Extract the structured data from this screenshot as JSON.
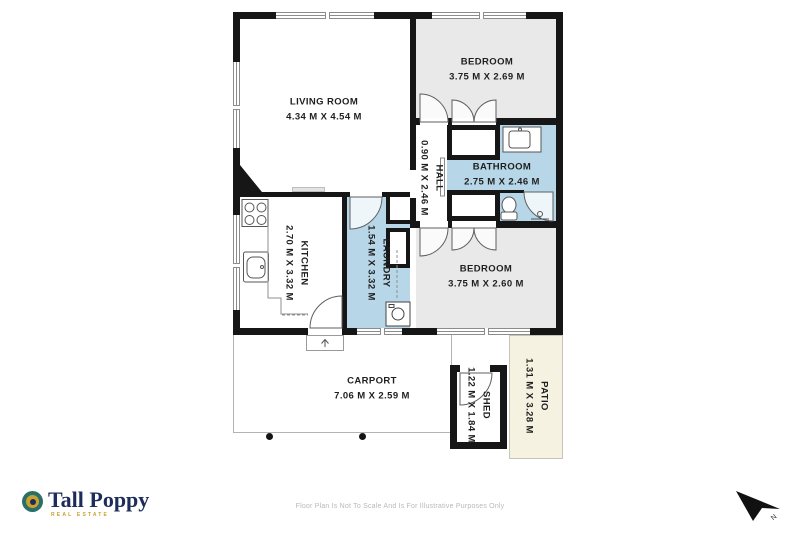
{
  "plan": {
    "rooms": [
      {
        "id": "living-room",
        "name": "LIVING ROOM",
        "dims": "4.34 M X 4.54 M"
      },
      {
        "id": "bedroom-1",
        "name": "BEDROOM",
        "dims": "3.75 M X 2.69 M"
      },
      {
        "id": "bathroom",
        "name": "BATHROOM",
        "dims": "2.75 M X 2.46 M"
      },
      {
        "id": "hall",
        "name": "HALL",
        "dims": "0.90 M X 2.46 M"
      },
      {
        "id": "kitchen",
        "name": "KITCHEN",
        "dims": "2.70 M X 3.32 M"
      },
      {
        "id": "laundry",
        "name": "LAUNDRY",
        "dims": "1.54 M X 3.32 M"
      },
      {
        "id": "bedroom-2",
        "name": "BEDROOM",
        "dims": "3.75 M X 2.60 M"
      },
      {
        "id": "carport",
        "name": "CARPORT",
        "dims": "7.06 M X 2.59 M"
      },
      {
        "id": "shed",
        "name": "SHED",
        "dims": "1.22 M X 1.84 M"
      },
      {
        "id": "patio",
        "name": "PATIO",
        "dims": "1.31 M X 3.28 M"
      }
    ],
    "north_label": "N"
  },
  "branding": {
    "name": "Tall Poppy",
    "tagline": "REAL ESTATE"
  },
  "disclaimer": "Floor Plan Is Not To Scale And Is For Illustrative Purposes Only",
  "colors": {
    "wall": "#161616",
    "bedroom_fill": "#e9e9e9",
    "wet_fill": "#b7d7e9",
    "patio_fill": "#f5f2e1",
    "brand_navy": "#1e2c5c",
    "brand_gold": "#c9a12e",
    "brand_teal": "#2a6f68"
  }
}
